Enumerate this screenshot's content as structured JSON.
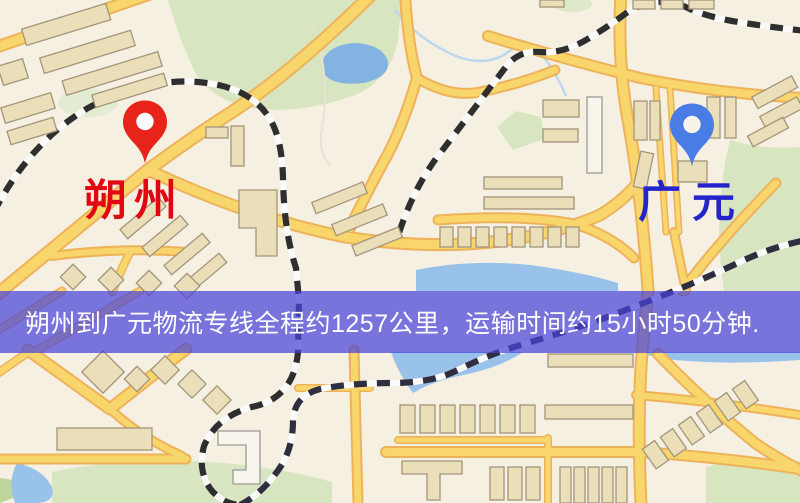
{
  "map": {
    "origin": {
      "name": "朔州",
      "pin_color": "#e8231a",
      "label_color": "#e30613"
    },
    "destination": {
      "name": "广元",
      "pin_color": "#4a7ce6",
      "label_color": "#2424cb"
    }
  },
  "route": {
    "distance": "1257公里",
    "duration": "15小时50分钟"
  },
  "banner": {
    "text": "朔州到广元物流专线全程约1257公里，运输时间约15小时50分钟.",
    "background": "#4a44d9",
    "opacity": 0.72,
    "text_color": "#ffffff"
  }
}
